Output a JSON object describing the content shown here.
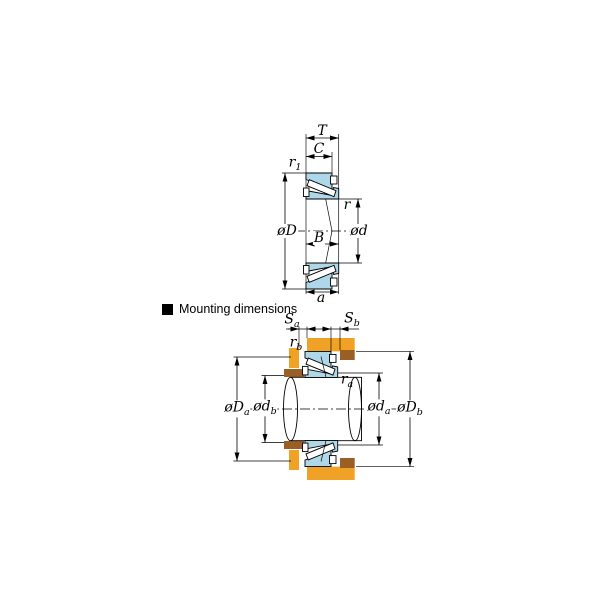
{
  "bearing_figure": {
    "labels": {
      "T": "T",
      "C": "C",
      "r1": {
        "base": "r",
        "sub": "1"
      },
      "outer_diameter": "øD",
      "r": "r",
      "bore_diameter": "ød",
      "B": "B",
      "a": "a"
    }
  },
  "mounting_figure": {
    "heading": "Mounting dimensions",
    "labels": {
      "Sa": {
        "base": "S",
        "sub": "a"
      },
      "Sb": {
        "base": "S",
        "sub": "b"
      },
      "rb": {
        "base": "r",
        "sub": "b"
      },
      "ra": {
        "base": "r",
        "sub": "a"
      },
      "Da": {
        "base": "øD",
        "sub": "a"
      },
      "db": {
        "base": "ød",
        "sub": "b"
      },
      "da": {
        "base": "ød",
        "sub": "a"
      },
      "Db": {
        "base": "øD",
        "sub": "b"
      }
    }
  },
  "colors": {
    "ring_blue": "#aed7ea",
    "roller_white": "#ffffff",
    "housing_orange": "#f0a226",
    "spacer_brown": "#9a5f24",
    "line": "#000000",
    "background": "#ffffff"
  }
}
